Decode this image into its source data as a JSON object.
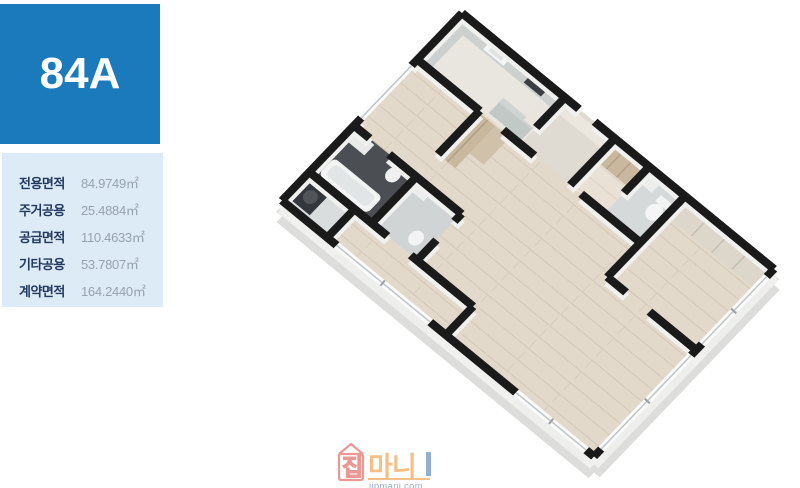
{
  "unit": {
    "label": "84A"
  },
  "area_table": {
    "rows": [
      {
        "label": "전용면적",
        "value": "84.9749㎡"
      },
      {
        "label": "주거공용",
        "value": "25.4884㎡"
      },
      {
        "label": "공급면적",
        "value": "110.4633㎡"
      },
      {
        "label": "기타공용",
        "value": "53.7807㎡"
      },
      {
        "label": "계약면적",
        "value": "164.2440㎡"
      }
    ]
  },
  "floorplan": {
    "type": "3d-isometric-apartment-floorplan",
    "unit": "84A"
  },
  "watermark": {
    "brand_house_char": "집",
    "brand_rest": "마니",
    "url": "jipmani.com"
  },
  "colors": {
    "badge_blue": "#1a7abc",
    "panel_light_blue": "#dcebf5",
    "label_navy": "#233a60",
    "value_gray": "#98a2ae",
    "wall_black": "#1a1a1a",
    "wood_floor": "#e3d9cb",
    "bath_dark_tile": "#4b4f53",
    "counter_gray": "#ccd1cf",
    "wardrobe_tan": "#c9b79e",
    "watermark_red": "#d9453c",
    "watermark_orange": "#f08c28",
    "watermark_navy": "#4a6fa5"
  }
}
